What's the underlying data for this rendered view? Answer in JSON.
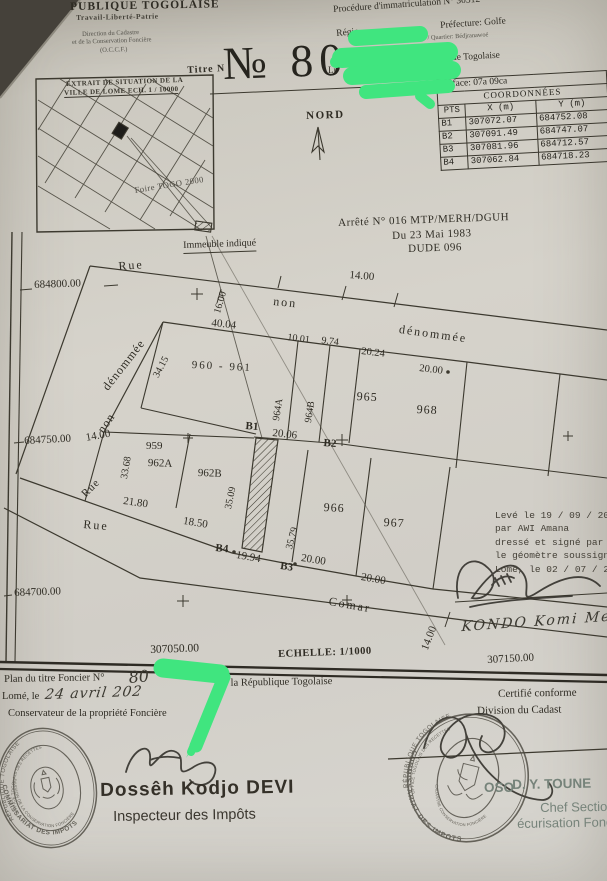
{
  "header": {
    "republic": "PUBLIQUE TOGOLAISE",
    "motto": "Travail-Liberté-Patrie",
    "dir1": "Direction du Cadastre",
    "dir2": "et de la Conservation Foncière",
    "dir3": "(O.C.C.F.)",
    "titre_label": "Titre N",
    "titre_no": "№ 80",
    "procedure": "Procédure d'immatriculation N° 30312",
    "prefecture": "Préfecture: Golfe",
    "region_frag": "Régio",
    "canton": "Bè-Centre  /  Quartier: Bédjranawoé",
    "republic2": "République Togolaise",
    "lieu_frag": "Li"
  },
  "coords": {
    "surface": "Surface: 07a 09ca",
    "title": "COORDONNÉES",
    "col_pts": "PTS",
    "col_x": "X (m)",
    "col_y": "Y (m)",
    "rows": [
      {
        "pt": "B1",
        "x": "307072.07",
        "y": "684752.08"
      },
      {
        "pt": "B2",
        "x": "307091.49",
        "y": "684747.07"
      },
      {
        "pt": "B3",
        "x": "307081.96",
        "y": "684712.57"
      },
      {
        "pt": "B4",
        "x": "307062.84",
        "y": "684718.23"
      }
    ]
  },
  "inset": {
    "title1": "EXTRAIT DE SITUATION DE LA",
    "title2": "VILLE DE LOME ECH. 1 / 10000",
    "foire": "Foire TOGO 2000",
    "immeuble": "Immeuble indiqué"
  },
  "arrete": {
    "l1": "Arrêté N° 016 MTP/MERH/DGUH",
    "l2": "Du 23 Mai 1983",
    "l3": "DUDE 096"
  },
  "north": "NORD",
  "plan": {
    "grid": {
      "y800": "684800.00",
      "y750": "684750.00",
      "y700": "684700.00",
      "x050": "307050.00",
      "x150": "307150.00"
    },
    "scale": "ECHELLE: 1/1000",
    "streets": {
      "rue_top": "Rue",
      "non_top": "non",
      "denommee_top": "dénommée",
      "denommee_left": "dénommée",
      "non_left": "non",
      "rue_diag": "Rue",
      "rue_mid": "Rue",
      "comar": "Comar"
    },
    "parcels": {
      "p960": "960 - 961",
      "p959": "959",
      "p962a": "962A",
      "p962b": "962B",
      "p964a": "964A",
      "p964b": "964B",
      "p965": "965",
      "p966": "966",
      "p967": "967",
      "p968": "968"
    },
    "points": {
      "b1": "B1",
      "b2": "B2",
      "b3": "B3",
      "b4": "B4"
    },
    "measures": {
      "m16": "16.00",
      "m14_top": "14.00",
      "m40_04": "40.04",
      "m34_15": "34.15",
      "m10_01": "10.01",
      "m9_74": "9.74",
      "m20_24": "20.24",
      "m20_00_r": "20.00",
      "m14_left": "14.00",
      "m33_68": "33.68",
      "m20_06": "20.06",
      "m35_09": "35.09",
      "m35_79": "35.79",
      "m21_80": "21.80",
      "m18_50": "18.50",
      "m19_94": "19.94",
      "m20_00_b1": "20.00",
      "m20_00_b2": "20.00",
      "m14_bot": "14.00"
    }
  },
  "surveyor": {
    "l1": "Levé le 19 / 09 / 201",
    "l2": "par AWI Amana",
    "l3": "dressé et signé par",
    "l4": "le géomètre soussigné",
    "l5": "Lomé, le 02 / 07 / 2",
    "name": "KONDO Komi Mensa"
  },
  "footer": {
    "plan_label": "Plan du titre Foncier N°",
    "plan_no": "80",
    "of_republic": "de la République Togolaise",
    "lome_le": "Lomé, le",
    "date_hand": "24 avril 202",
    "conservateur": "Conservateur de la propriété Foncière",
    "certifie": "Certifié conforme",
    "division": "Division du Cadast",
    "inspector_name": "Dossêh Kodjo DEVI",
    "inspector_title": "Inspecteur des Impôts",
    "chef_frag": "OSO",
    "chef_name": "D. Y. TOUNE",
    "chef_title": "Chef Section",
    "chef_service": "écurisation Fonc"
  },
  "stamps": {
    "left_top": "RÉPUBLIQUE TOGOLAISE",
    "left_mid": "OFFICE TOGOLAIS DES RECETTES",
    "left_bottom": "COMMISSARIAT DES IMPOTS",
    "left_inner": "DIVISION DE LA CONSERVATION FONCIÈRE",
    "right_top": "RÉPUBLIQUE TOGOLAISE",
    "right_mid": "OFFICE TOGOLAIS DES RECETTES",
    "right_bottom": "COMMISSARIAT DES IMPOTS",
    "right_inner": "CADASTRE CONSERVATION FONCIÈRE"
  },
  "colors": {
    "green": "#40e57f",
    "ink": "#3c392f",
    "paper": "#d4d1c9"
  }
}
